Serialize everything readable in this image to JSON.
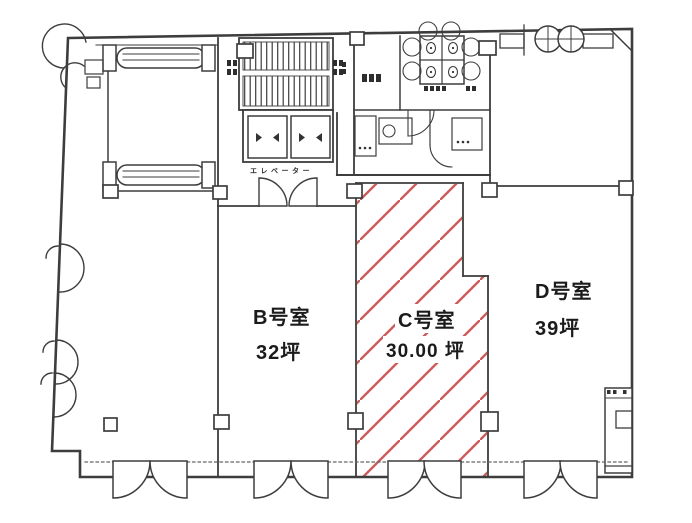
{
  "floor_plan": {
    "rooms": [
      {
        "id": "B",
        "name": "B号室",
        "area": "32坪",
        "highlighted": false
      },
      {
        "id": "C",
        "name": "C号室",
        "area": "30.00 坪",
        "highlighted": true
      },
      {
        "id": "D",
        "name": "D号室",
        "area": "39坪",
        "highlighted": false
      }
    ],
    "core": {
      "elevator_label": "エレベーター"
    },
    "highlight": {
      "room_id": "C",
      "hatch_color": "#cc5b5b",
      "hatch_style": "diagonal-lines"
    },
    "colors": {
      "line": "#3d3d3d",
      "text": "#1b1b1b",
      "background": "#ffffff"
    },
    "fixtures": [
      "escalator-icon",
      "staircase-icon",
      "elevator-icon",
      "toilet-icon",
      "double-door-icon"
    ]
  }
}
